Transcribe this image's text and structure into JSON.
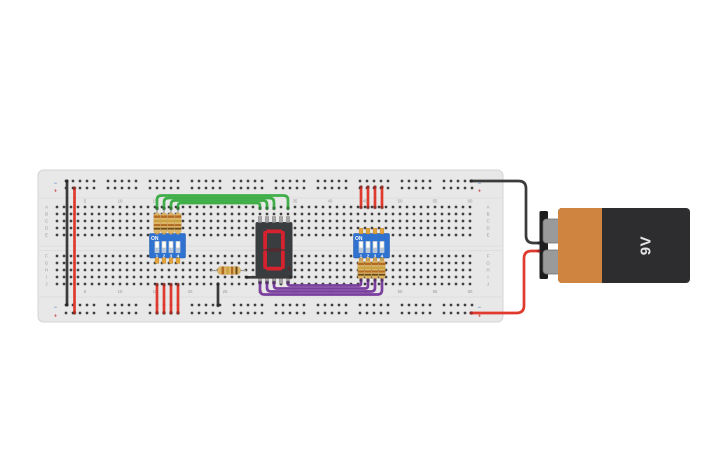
{
  "breadboard": {
    "row_letters_top": [
      "A",
      "B",
      "C",
      "D",
      "E"
    ],
    "row_letters_bottom": [
      "F",
      "G",
      "H",
      "I",
      "J"
    ],
    "column_labels": [
      "5",
      "10",
      "15",
      "20",
      "25",
      "30",
      "35",
      "40",
      "45",
      "50",
      "55",
      "60"
    ],
    "rail_negative_label": "−",
    "rail_positive_label": "+",
    "board_color": "#e8e8e8",
    "border_color": "#d4d4d4",
    "hole_color": "#3f3f3f",
    "label_color": "#989898",
    "negative_color": "#5b87c5",
    "positive_color": "#cc5149"
  },
  "dip_left": {
    "on_label": "ON",
    "pin_labels": [
      "1",
      "2",
      "3",
      "4"
    ],
    "switch_state": "on",
    "body_color": "#2f72cf",
    "pin_color": "#e5a33c",
    "slot_color": "#b9c7d6",
    "slider_color": "#ffffff"
  },
  "dip_right": {
    "on_label": "ON",
    "pin_labels": [
      "1",
      "2",
      "3",
      "4"
    ],
    "switch_state": "on",
    "body_color": "#2f72cf",
    "pin_color": "#e5a33c",
    "slot_color": "#b9c7d6",
    "slider_color": "#ffffff"
  },
  "seven_segment": {
    "value": "0",
    "lit_segments": [
      "a",
      "b",
      "c",
      "d",
      "e",
      "f"
    ],
    "lit_color": "#d6212f",
    "unlit_color": "#542a2e",
    "body_color": "#3a3d40",
    "pin_color": "#a6a6a6"
  },
  "battery": {
    "label": "9V",
    "body_dark_color": "#2d2d30",
    "body_orange_color": "#cf8440",
    "terminal_color": "#9a9a9a",
    "plate_color": "#1d1d1f",
    "text_color": "#e4e4e4"
  },
  "resistor": {
    "body_color": "#dcb567",
    "band1_color": "#b26b22",
    "band2_color": "#c9a13b",
    "band3_color": "#b26b22",
    "band4_color": "#6b4a18",
    "lead_color": "#9a9a9a"
  },
  "wires": {
    "black": "#3b3b3b",
    "red": "#e03a2e",
    "green": "#3fae49",
    "purple": "#7b3f9f"
  }
}
